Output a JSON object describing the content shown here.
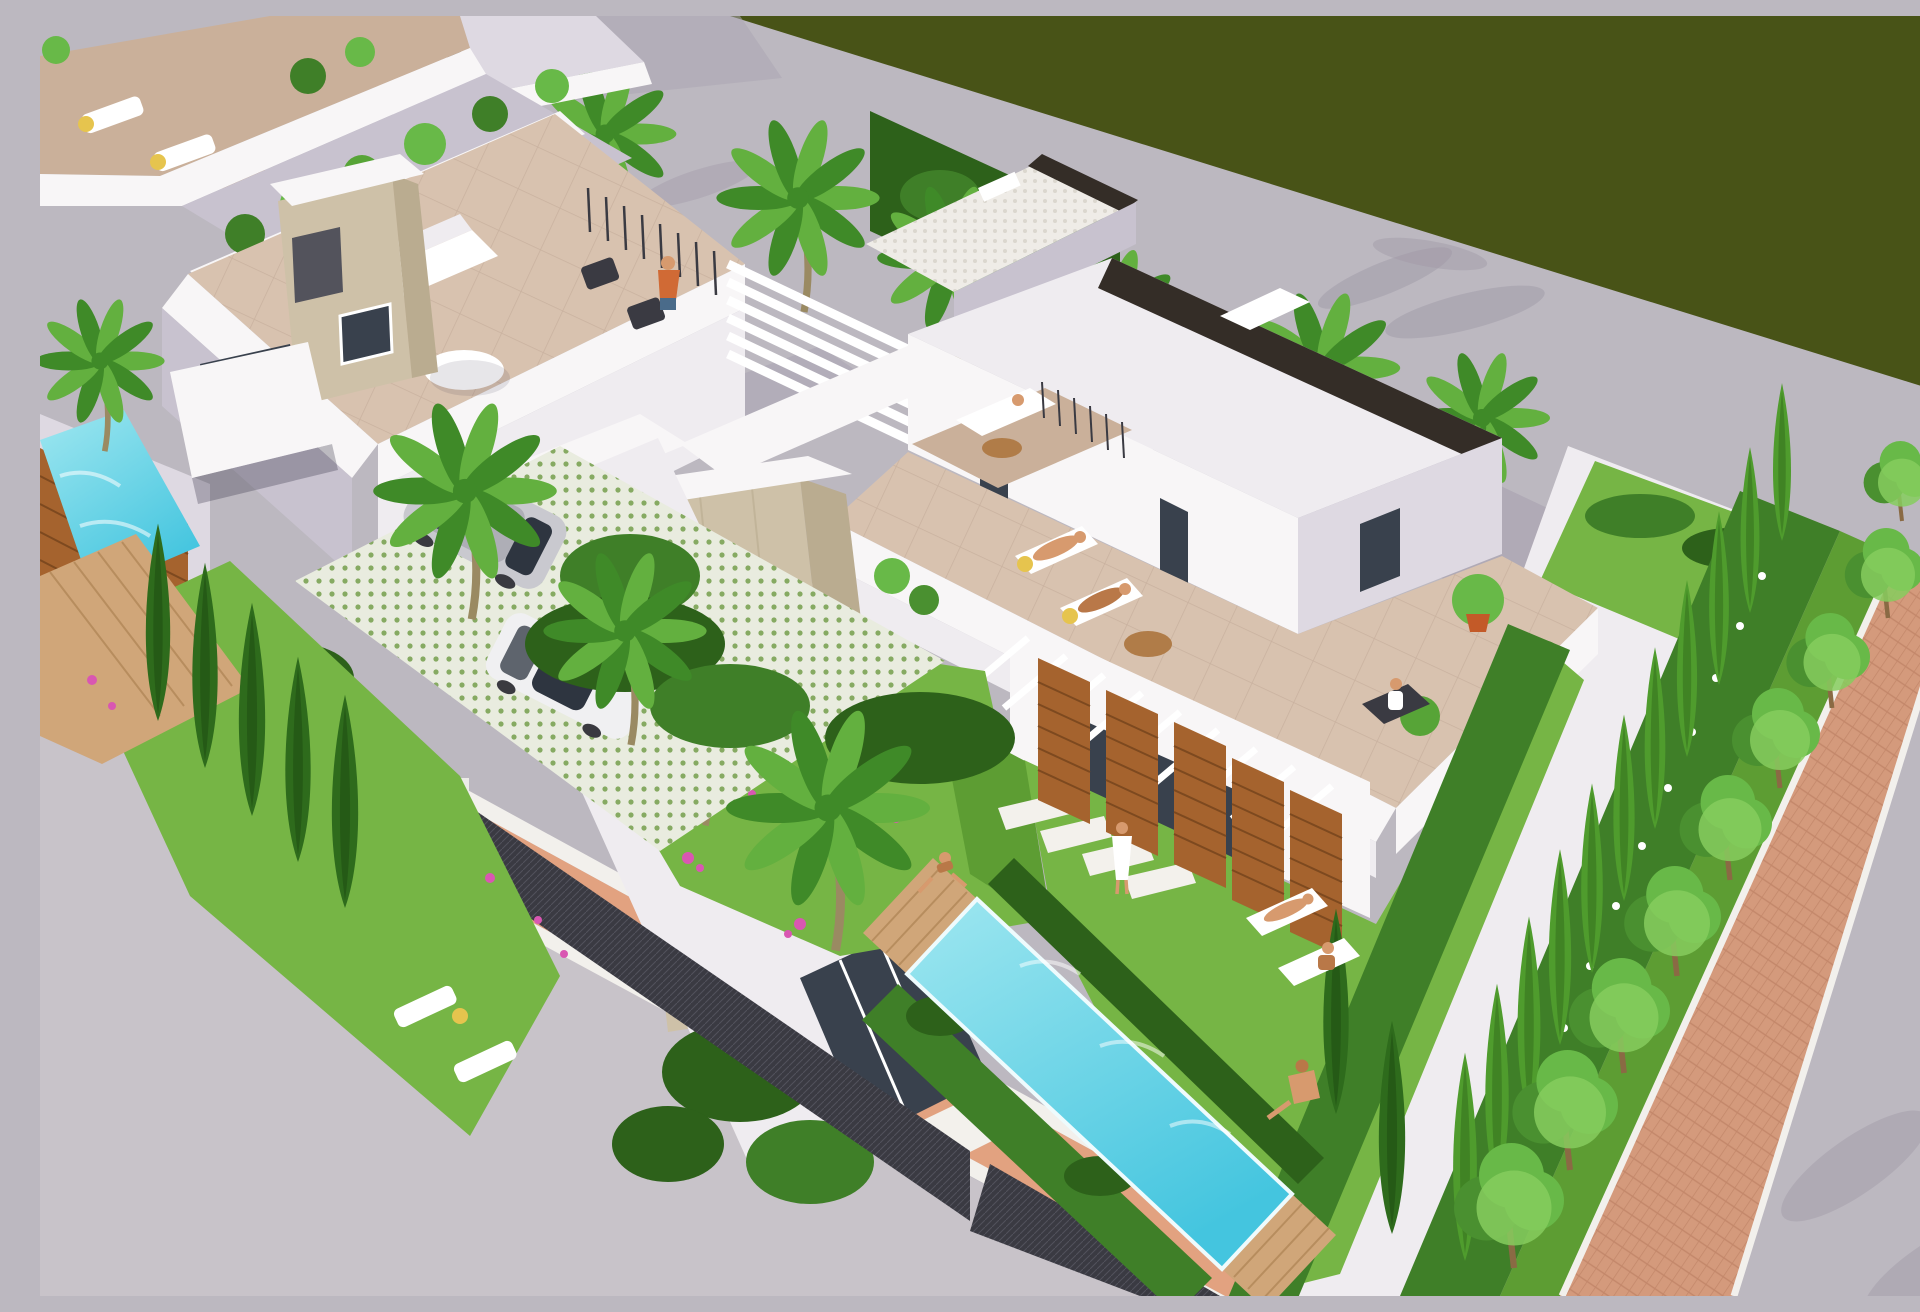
{
  "scene": {
    "type": "architectural-3d-render",
    "view": "aerial-isometric",
    "subject": "Modern white villas with rooftop terraces, private pools and landscaped gardens along a street, beside a dark green field",
    "time_of_day": "midday",
    "villas_visible": 3,
    "pools": 2,
    "cars": 2,
    "people": 10
  },
  "objects": {
    "road_palms": 6,
    "street_trees": 9,
    "left_garden_cypresses": 5,
    "right_hedge_cypresses": 11,
    "sun_loungers": 10,
    "stone_chimneys": 2,
    "wood_slat_screens": 7,
    "fence_posts": 2,
    "pergolas": 3,
    "stepping_stones": 4
  },
  "palette": {
    "olive": "#485317",
    "roadA": "#bcb8c0",
    "roadB": "#c8c3c9",
    "roadShadow": "#9d97a5",
    "roadShadowSoft": "#aca6b3",
    "curb": "#f2f0ec",
    "sidewalk": "#e2a280",
    "brick": "#d49a7c",
    "brickLine": "#bd7f63",
    "wallTop": "#f8f6f7",
    "wallLight": "#efecf0",
    "wallMid": "#ded9e2",
    "wallShade": "#c8c2cf",
    "wallDark": "#b0aaba",
    "glass": "#39414d",
    "trim": "#342d27",
    "stone": "#cec1a8",
    "stoneShade": "#baac90",
    "grate": "#53535c",
    "grateLine": "#9a9aa2",
    "terraceA": "#d8c2af",
    "terraceB": "#cab09a",
    "grass": "#76b545",
    "grassDark": "#5d9d33",
    "hedge": "#3f7f28",
    "hedgeDark": "#2d611a",
    "hedgeLight": "#57a437",
    "cypress": "#4f9c2d",
    "cypressCore": "#356f1e",
    "cypressDark": "#2e6b1c",
    "cypressDarkCore": "#1f4f12",
    "tree": "#68b948",
    "treeDark": "#4a9030",
    "treeLight": "#86cc5e",
    "trunkBrown": "#8a6a44",
    "palm": "#63b03f",
    "palmDark": "#3f8a28",
    "trunk": "#9a8a62",
    "deck": "#d0a679",
    "deckLine": "#b18758",
    "poolLight": "#9fe7f0",
    "poolDeep": "#44c5df",
    "poolEdge": "#eefbfd",
    "wood": "#a5632e",
    "woodDark": "#7d491f",
    "fence": "#3a3a42",
    "fenceLine": "#52525c",
    "post": "#ecebe8",
    "white": "#ffffff",
    "cream": "#f3f1ec",
    "mosaic": "#efece7",
    "mosaicDot": "#dbd7ce",
    "paverBase": "#e9ecdf",
    "paverDot": "#86aa62",
    "carSilver": "#c9c9cf",
    "carSilverDark": "#aeaeb6",
    "carWhite": "#f0f0f2",
    "carGlass": "#2e3540",
    "wheel": "#3a3a40",
    "skin": "#d79a6e",
    "skinDark": "#b97848",
    "pink": "#d957b2",
    "pot": "#c35a28",
    "yellow": "#e6c44e",
    "wicker": "#b07c48",
    "orange": "#d06a35"
  }
}
